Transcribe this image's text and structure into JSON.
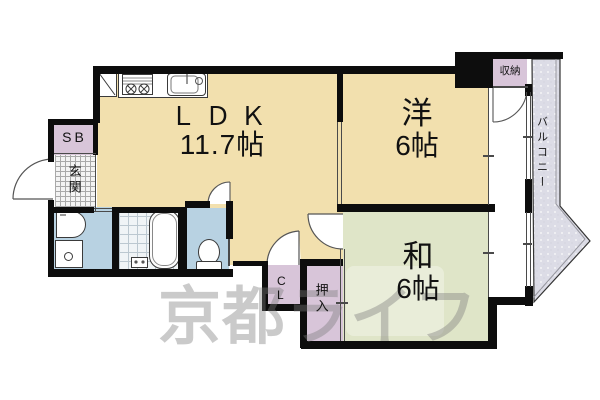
{
  "watermark": "京都ライフ",
  "rooms": {
    "ldk": {
      "name": "ＬＤＫ",
      "size": "11.7帖"
    },
    "western": {
      "name": "洋",
      "size": "6帖"
    },
    "japanese": {
      "name": "和",
      "size": "6帖"
    }
  },
  "areas": {
    "storage": "収納",
    "balcony": "バルコニー",
    "shoe_box": "SB",
    "entrance": "玄関",
    "closet": "CL",
    "futon_closet": "押入"
  },
  "colors": {
    "room_tan": "#f2e0ae",
    "tatami_green": "#dfe5c8",
    "closet_lavender": "#d8c5d9",
    "sanitary_blue": "#b8d2e2",
    "balcony_gray": "#dcdce6",
    "wall_black": "#0d0d0d"
  }
}
